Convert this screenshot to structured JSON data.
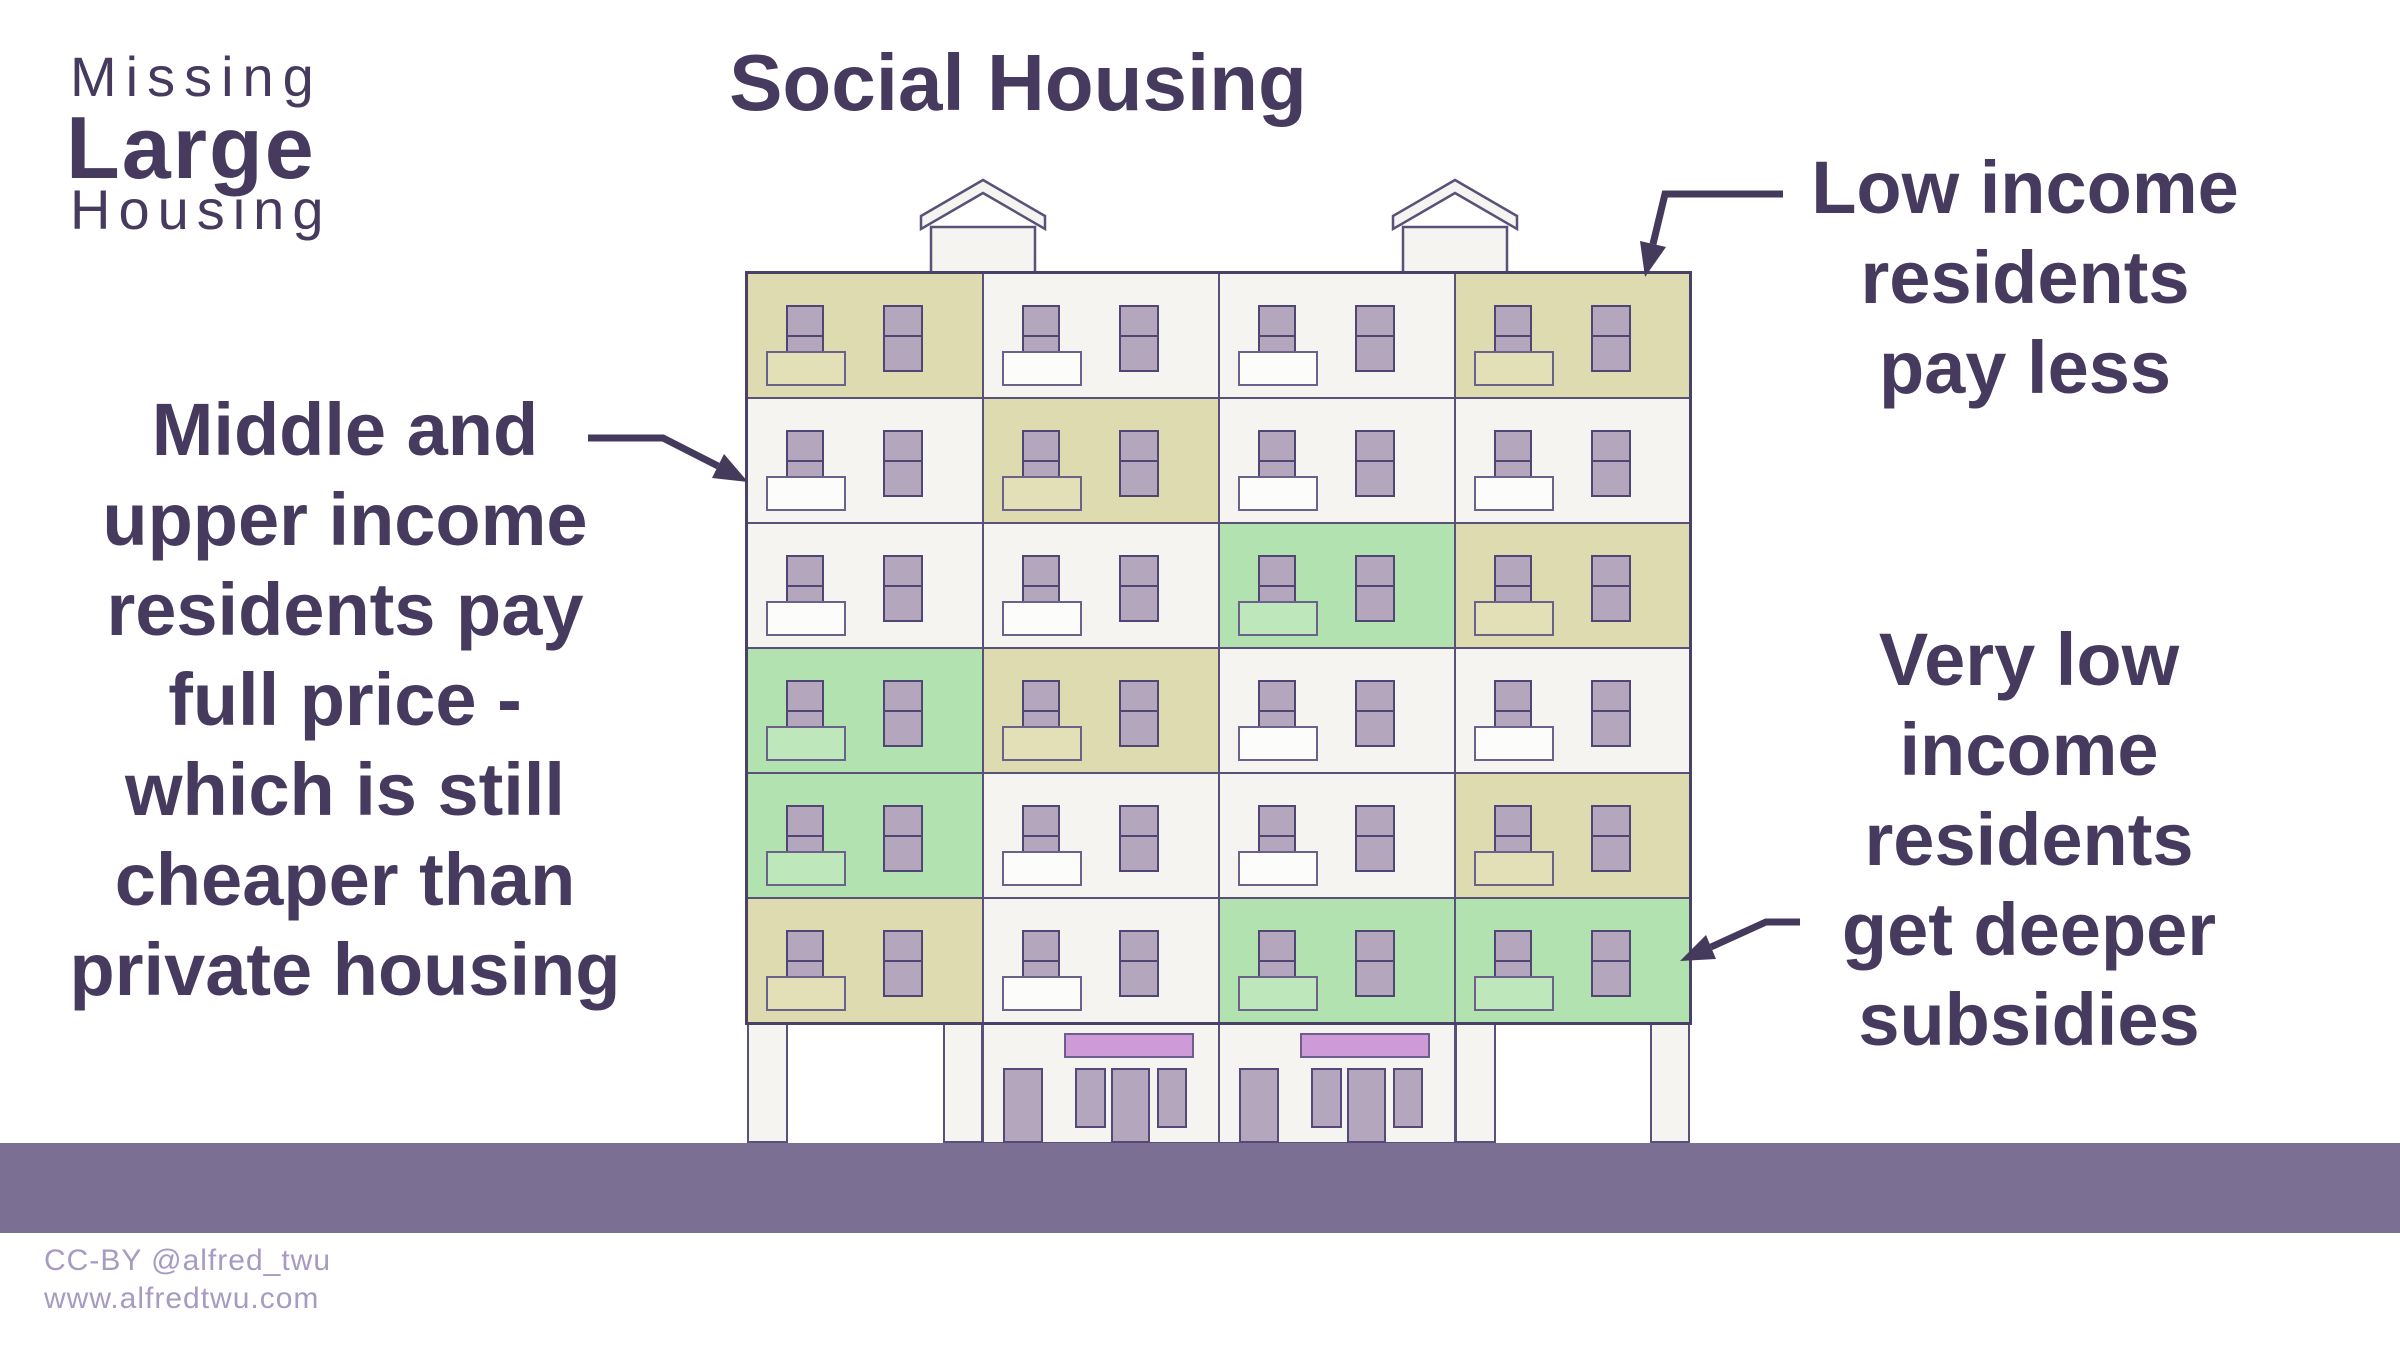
{
  "logo": {
    "line1": "Missing",
    "line2": "Large",
    "line3": "Housing"
  },
  "title": "Social Housing",
  "annotations": {
    "middle_income": {
      "lines": [
        "Middle and",
        "upper income",
        "residents pay",
        "full price -",
        "which is still",
        "cheaper than",
        "private housing"
      ]
    },
    "low_income": {
      "lines": [
        "Low income",
        "residents",
        "pay less"
      ]
    },
    "very_low_income": {
      "lines": [
        "Very low",
        "income",
        "residents",
        "get deeper",
        "subsidies"
      ]
    }
  },
  "footer": {
    "line1": "CC-BY @alfred_twu",
    "line2": "www.alfredtwu.com"
  },
  "building": {
    "tiers": {
      "market": {
        "label": "middle and upper income unit",
        "color": "#f5f4f1",
        "balcony": "#fcfcfa"
      },
      "low": {
        "label": "low income unit",
        "color": "#dedbb0",
        "balcony": "#e3e0b8"
      },
      "verylow": {
        "label": "very low income unit",
        "color": "#b2e2b0",
        "balcony": "#bee7bc"
      }
    },
    "floors": [
      [
        "low",
        "market",
        "market",
        "low"
      ],
      [
        "market",
        "low",
        "market",
        "market"
      ],
      [
        "market",
        "market",
        "verylow",
        "low"
      ],
      [
        "verylow",
        "low",
        "market",
        "market"
      ],
      [
        "verylow",
        "market",
        "market",
        "low"
      ],
      [
        "low",
        "market",
        "verylow",
        "verylow"
      ]
    ],
    "ground_floor": {
      "sections": [
        "pillars",
        "storefront",
        "storefront",
        "pillars"
      ],
      "sign_color": "#ce9ad8",
      "door_color": "#b3a6bd"
    },
    "window_color": "#b3a6bd",
    "penthouse_color": "#f5f4f1",
    "outline_color": "#5a5178",
    "street_color": "#7b7093"
  },
  "colors": {
    "text": "#463b5e",
    "arrow": "#443a5c",
    "footer_text": "#a79bc2"
  }
}
